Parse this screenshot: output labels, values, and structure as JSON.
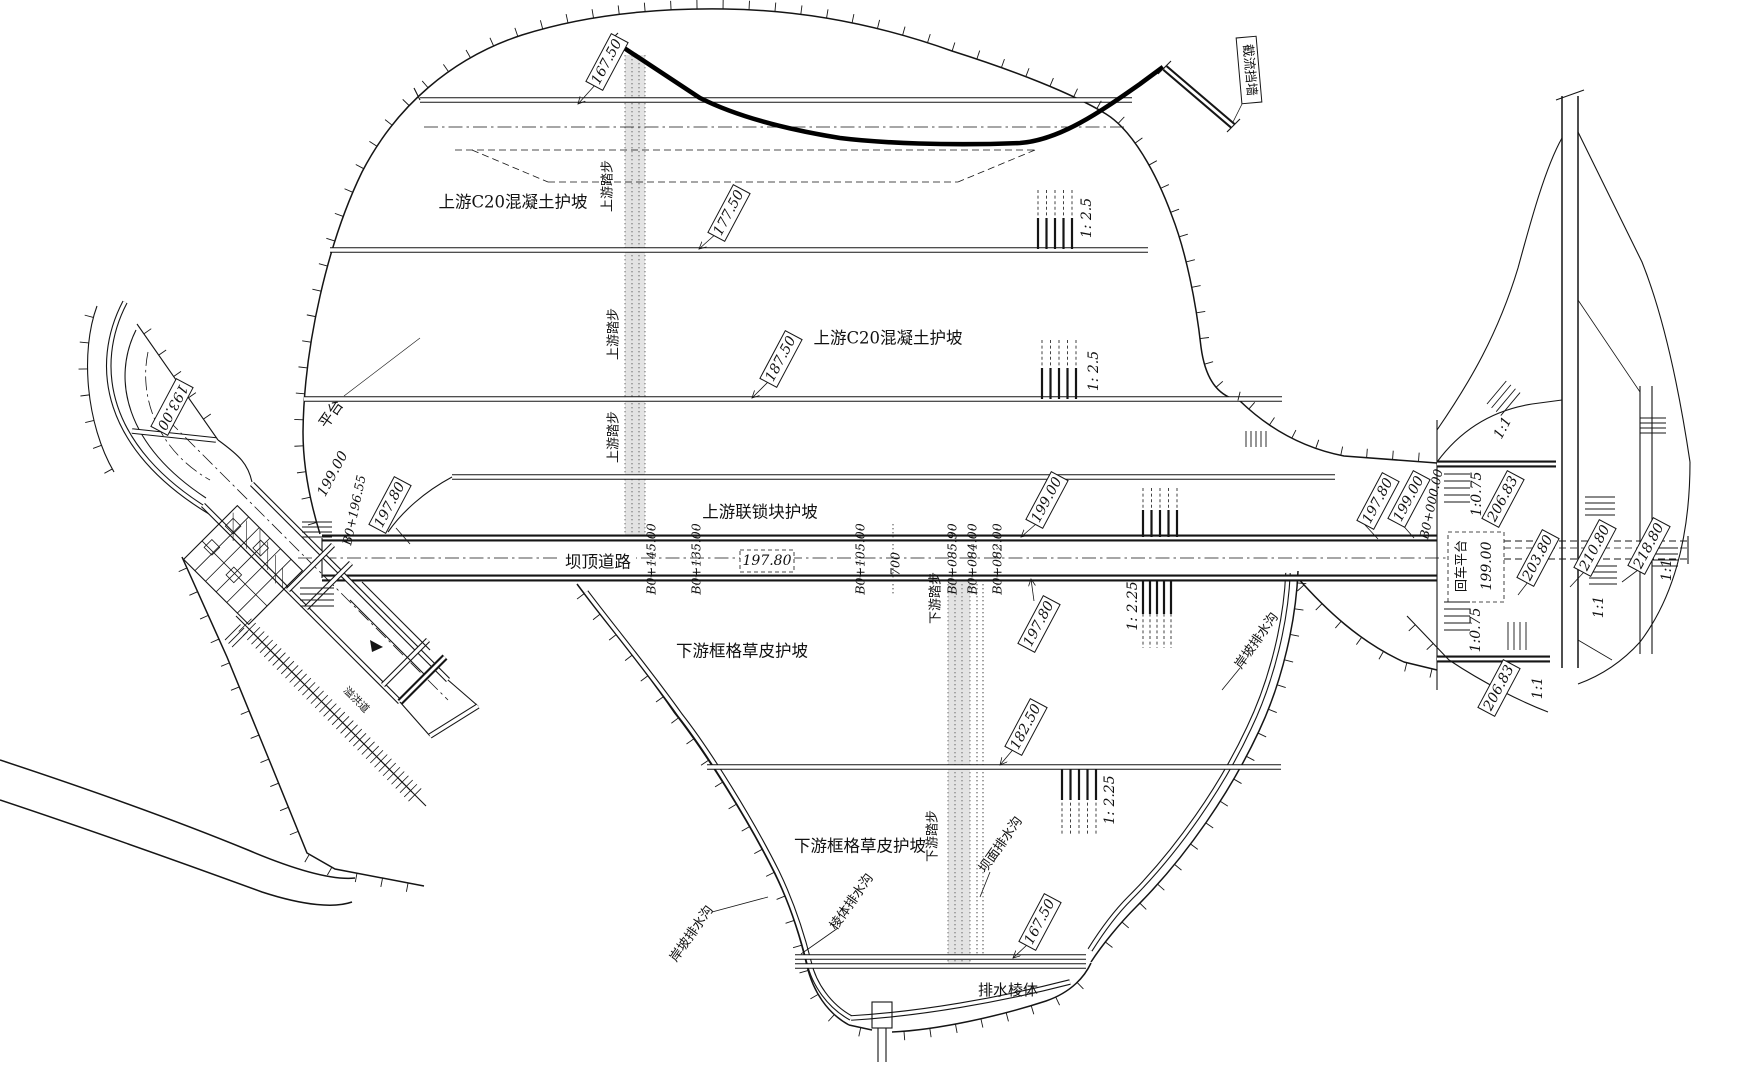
{
  "colors": {
    "ink": "#151515",
    "paper": "#ffffff",
    "strip": "#d9d9d9"
  },
  "labels": {
    "upstream": {
      "zone_concrete_a": "上游C20混凝土护坡",
      "zone_concrete_b": "上游C20混凝土护坡",
      "zone_interlock": "上游联锁块护坡",
      "steps_a": "上游踏步",
      "steps_b": "上游踏步",
      "steps_c": "上游踏步",
      "elev_167": "167.50",
      "elev_177": "177.50",
      "elev_187": "187.50",
      "elev_199": "199.00",
      "slope_a": "1: 2.5",
      "slope_b": "1: 2.5"
    },
    "road": {
      "name": "坝顶道路",
      "elev": "197.80",
      "sta_145": "B0+145.00",
      "sta_135": "B0+135.00",
      "sta_105": "B0+105.00",
      "dim_700": "700",
      "sta_085": "B0+085.90",
      "sta_084": "B0+084.00",
      "sta_082": "B0+082.00"
    },
    "downstream": {
      "zone_grass_a": "下游框格草皮护坡",
      "zone_grass_b": "下游框格草皮护坡",
      "steps_a": "下游踏步",
      "steps_b": "下游踏步",
      "elev_197": "197.80",
      "elev_182": "182.50",
      "elev_167": "167.50",
      "slope_a": "1: 2.25",
      "slope_b": "1: 2.25",
      "drain_face": "坝面排水沟",
      "drain_prism": "棱体排水沟",
      "drain_bank_left": "岸坡排水沟",
      "drain_bank_right": "岸坡排水沟",
      "prism": "排水棱体"
    },
    "left": {
      "elev_193": "193.00",
      "platform": "平台",
      "elev_199": "199.00",
      "sta": "B0+196.55",
      "elev_197": "197.80",
      "spillway": "溢洪道"
    },
    "right": {
      "elev_197": "197.80",
      "elev_199": "199.00",
      "sta_000": "B0+000.00",
      "turn_platform": "回车平台",
      "turn_elev": "199.00",
      "slope_075_a": "1:0.75",
      "slope_075_b": "1:0.75",
      "elev_206_a": "206.83",
      "elev_206_b": "206.83",
      "elev_203": "203.80",
      "elev_210": "210.80",
      "elev_218": "218.80",
      "slope_11_a": "1:1",
      "slope_11_b": "1:1",
      "slope_11_c": "1:1",
      "slope_11_d": "1:1"
    },
    "top": {
      "cutoff_wall": "截流挡墙"
    }
  }
}
